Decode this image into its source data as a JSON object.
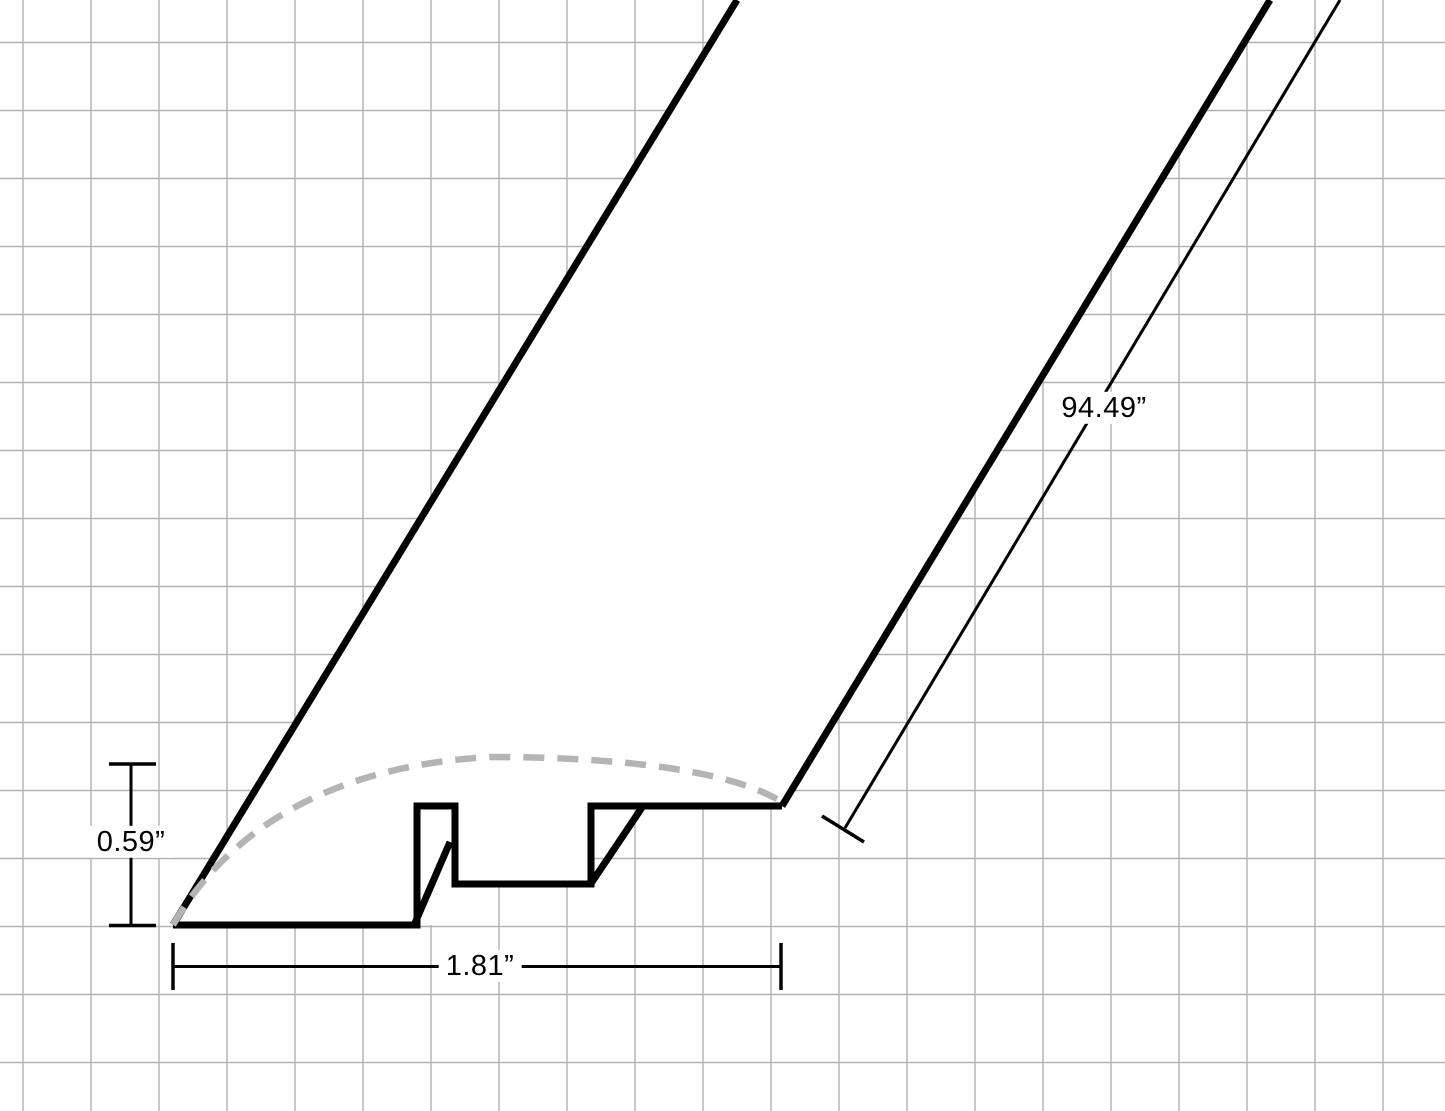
{
  "canvas": {
    "width": 1445,
    "height": 1111,
    "background": "#ffffff"
  },
  "grid": {
    "spacing": 68,
    "offset_x": 23,
    "offset_y": 42.5,
    "color": "#b0b0b0",
    "stroke_width": 1.4
  },
  "drawing": {
    "ink_color": "#000000",
    "outline_width": 7,
    "surface_dash_color": "#b4b4b4",
    "surface_dash_width": 6.5,
    "surface_dash_pattern": "21 13",
    "body_fill": "#ffffff",
    "mask_polygon": [
      [
        173,
        925
      ],
      [
        455,
        925
      ],
      [
        455,
        884
      ],
      [
        591,
        884
      ],
      [
        591,
        806
      ],
      [
        782,
        806
      ],
      [
        1270,
        0
      ],
      [
        737,
        0
      ]
    ],
    "profile_outline": [
      [
        173,
        925
      ],
      [
        417,
        925
      ],
      [
        417,
        806
      ],
      [
        455,
        806
      ],
      [
        455,
        884
      ],
      [
        591,
        884
      ],
      [
        591,
        806
      ],
      [
        782,
        806
      ]
    ],
    "extrusion_edges": [
      {
        "name": "left-extrusion-edge",
        "x1": 173,
        "y1": 925,
        "x2": 737,
        "y2": 0
      },
      {
        "name": "right-extrusion-edge",
        "x1": 782,
        "y1": 806,
        "x2": 1270,
        "y2": 0
      }
    ],
    "inner_corner_edges": [
      {
        "name": "tab-corner-edge",
        "x1": 415,
        "y1": 923,
        "x2": 450,
        "y2": 842
      },
      {
        "name": "groove-corner-edge",
        "x1": 592,
        "y1": 882,
        "x2": 643,
        "y2": 806
      }
    ],
    "rounded_top_curve": "M 173 925 C 228 830 330 766 490 757 C 620 757 730 770 782 802"
  },
  "dimensions": {
    "line_width": 3,
    "cap_width": 3.5,
    "height": {
      "label": "0.59”",
      "value_inches": 0.59,
      "line": {
        "x1": 131,
        "y1": 765,
        "x2": 131,
        "y2": 924
      },
      "caps": [
        {
          "x1": 109,
          "y1": 764,
          "x2": 156,
          "y2": 764
        },
        {
          "x1": 109,
          "y1": 925.5,
          "x2": 156,
          "y2": 925.5
        }
      ],
      "label_pos": {
        "x": 131,
        "y": 842
      }
    },
    "width": {
      "label": "1.81”",
      "value_inches": 1.81,
      "line": {
        "x1": 173,
        "y1": 966.5,
        "x2": 781,
        "y2": 966.5
      },
      "caps": [
        {
          "x1": 173,
          "y1": 943,
          "x2": 173,
          "y2": 990
        },
        {
          "x1": 781,
          "y1": 943,
          "x2": 781,
          "y2": 990
        }
      ],
      "label_pos": {
        "x": 480,
        "y": 966
      }
    },
    "length": {
      "label": "94.49”",
      "value_inches": 94.49,
      "line": {
        "x1": 845,
        "y1": 828,
        "x2": 1340,
        "y2": 0
      },
      "caps": [
        {
          "x1": 822,
          "y1": 816,
          "x2": 864,
          "y2": 842
        }
      ],
      "label_pos": {
        "x": 1104,
        "y": 408
      }
    }
  }
}
